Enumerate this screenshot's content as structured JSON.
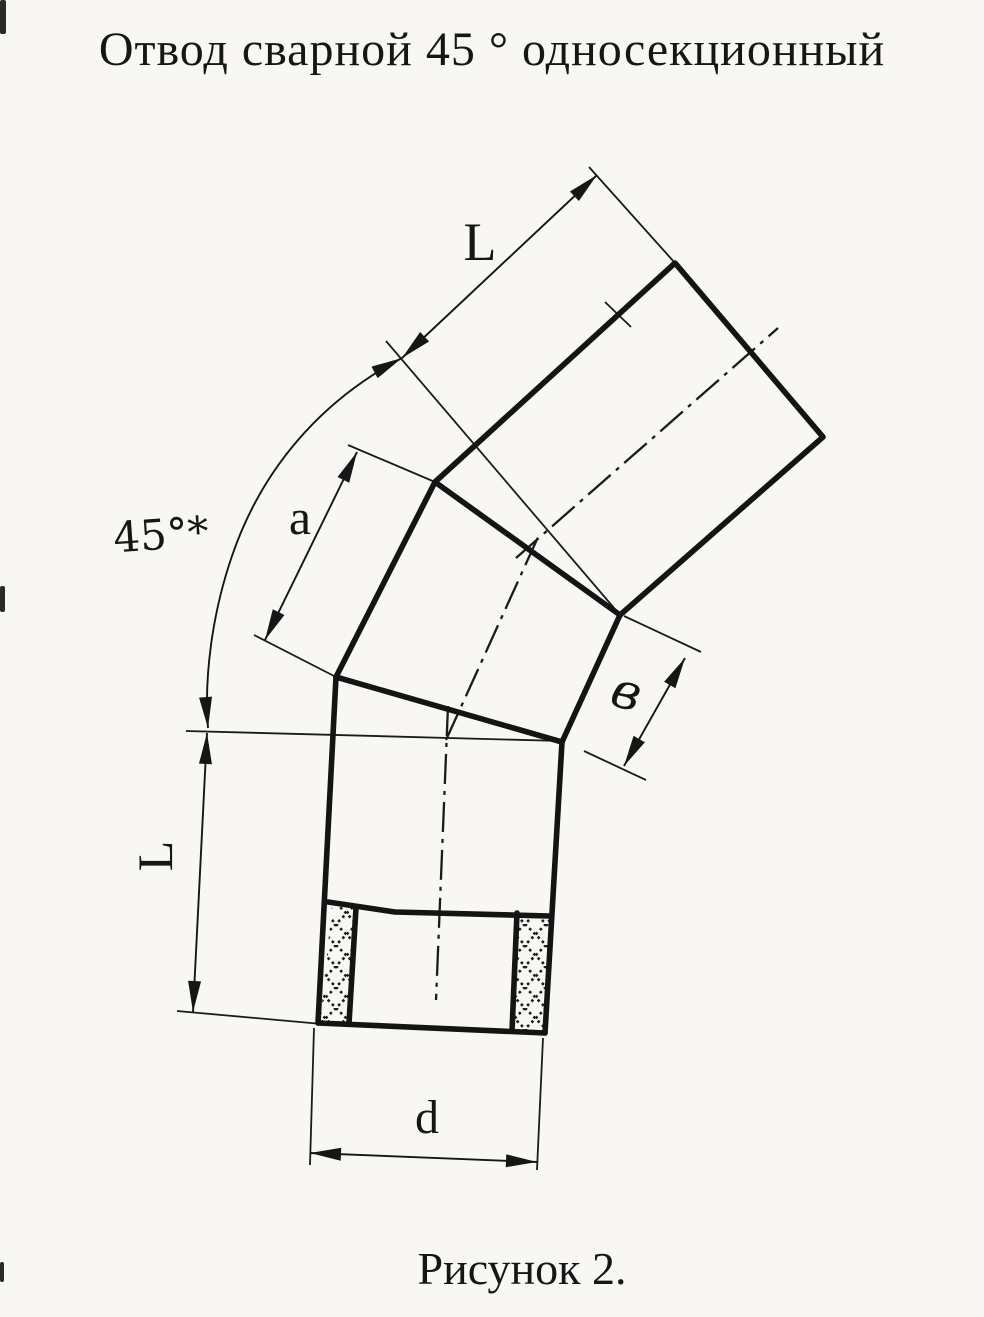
{
  "title": "Отвод сварной 45 ° односекционный",
  "caption": "Рисунок 2.",
  "labels": {
    "top_length": "L",
    "middle_length": "a",
    "bend_angle": "45°*",
    "end_width": "в",
    "left_length": "L",
    "diameter": "d"
  },
  "colors": {
    "ink": "#1b1b1b",
    "paper": "#f8f7f4"
  }
}
